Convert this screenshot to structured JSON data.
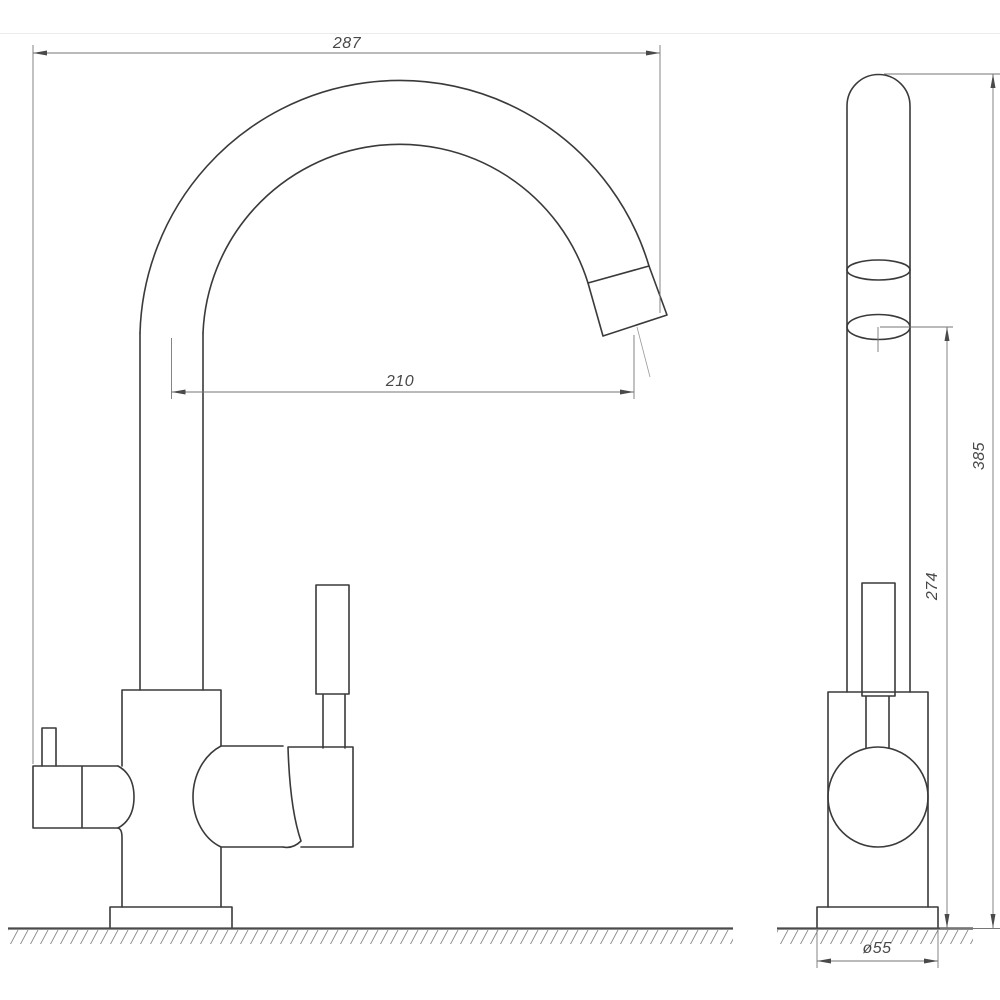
{
  "drawing": {
    "type": "technical-drawing",
    "subject": "kitchen faucet with high arc spout, front and side views with dimensions",
    "background_color": "#ffffff",
    "outline_color": "#3a3a3a",
    "dimension_line_color": "#767676",
    "text_color": "#484848",
    "frame_line_color": "#ececec",
    "dimensions": {
      "overall_width": "287",
      "spout_reach": "210",
      "overall_height": "385",
      "outlet_height": "274",
      "base_diameter": "ø55"
    }
  }
}
